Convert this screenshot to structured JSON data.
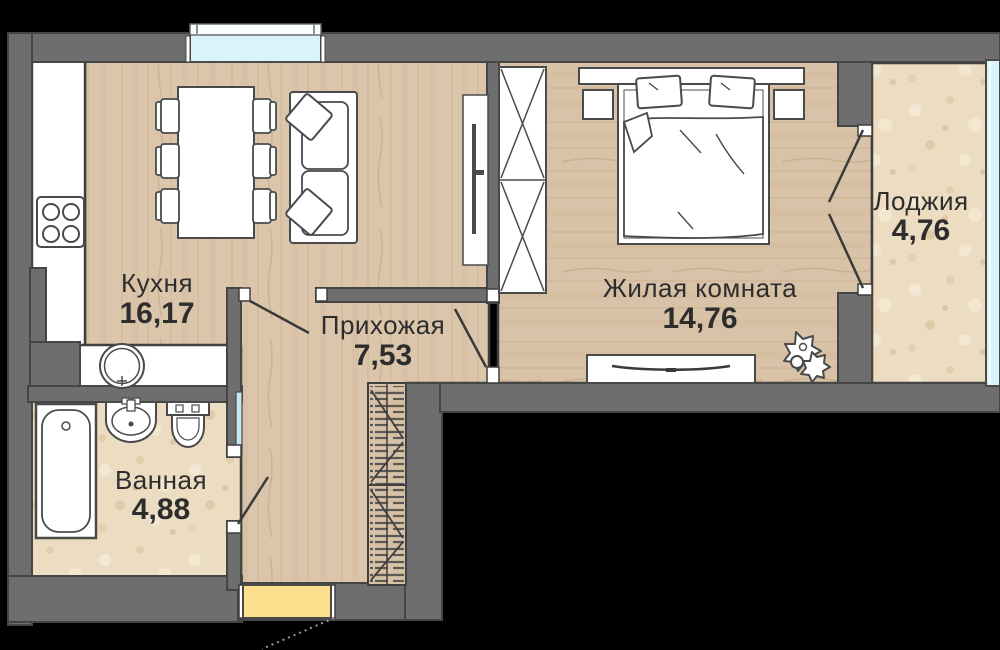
{
  "rooms": {
    "kitchen": {
      "name": "Кухня",
      "area": "16,17"
    },
    "hallway": {
      "name": "Прихожая",
      "area": "7,53"
    },
    "living_room": {
      "name": "Жилая комната",
      "area": "14,76"
    },
    "loggia": {
      "name": "Лоджия",
      "area": "4,76"
    },
    "bathroom": {
      "name": "Ванная",
      "area": "4,88"
    }
  },
  "colors": {
    "background": "#000000",
    "wall": "#6e6e6e",
    "wood_floor": "#dbc6ac",
    "stone_floor": "#ecdcc1",
    "window_glass": "#d8f3fb",
    "entrance_mat": "#fbdf8b",
    "outline": "#3f3f3f",
    "label_text": "#2d2d2d"
  },
  "furniture_symbols": [
    "kitchen-counter",
    "stove",
    "washing-machine",
    "dining-table",
    "chair",
    "sofa",
    "kitchen-tv-panel",
    "wardrobe",
    "bed",
    "pillow",
    "nightstand",
    "headboard-shelf",
    "tv-stand",
    "plant",
    "coat-rack",
    "bathtub",
    "washbasin",
    "toilet",
    "window",
    "loggia-glazing",
    "entrance-mat",
    "door-leaf"
  ]
}
